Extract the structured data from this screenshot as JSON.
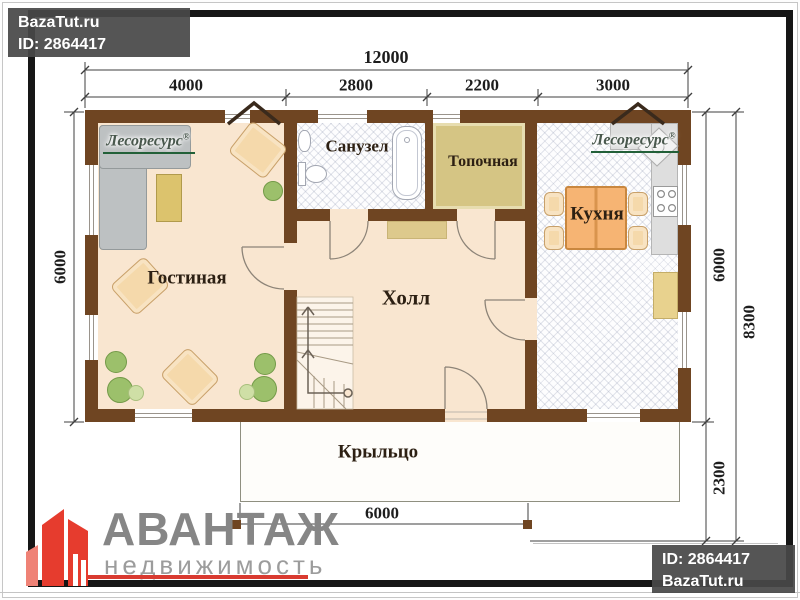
{
  "watermarks": {
    "top_left": {
      "site": "BazaTut.ru",
      "id": "ID: 2864417"
    },
    "bottom_right": {
      "id": "ID: 2864417",
      "site": "BazaTut.ru"
    }
  },
  "agency": {
    "name": "АВАНТАЖ",
    "subtitle": "недвижимость"
  },
  "brand": {
    "name": "Лесоресурс",
    "reg": "®"
  },
  "rooms": {
    "living": "Гостиная",
    "bathroom": "Санузел",
    "boiler": "Топочная",
    "kitchen": "Кухня",
    "hall": "Холл",
    "porch": "Крыльцо"
  },
  "dimensions": {
    "top_total": "12000",
    "top_segments": [
      "4000",
      "2800",
      "2200",
      "3000"
    ],
    "left_height": "6000",
    "right_main": "6000",
    "right_total": "8300",
    "right_porch": "2300",
    "porch_width": "6000"
  },
  "colors": {
    "wall": "#6f4522",
    "floor": "#f9e6d0",
    "boiler_floor": "#d5c584",
    "accent_red": "#e63c2e"
  }
}
